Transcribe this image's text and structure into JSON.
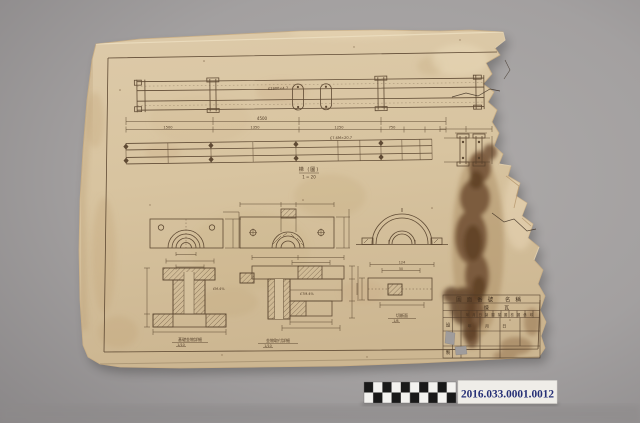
{
  "photo": {
    "accession_number": "2016.033.0001.0012"
  },
  "drawing": {
    "beam1_label": "£2800×4.7",
    "beam2_label": "£7.6M×20.7",
    "dim_total": "4500",
    "dim_seg1": "1500",
    "dim_seg2": "1350",
    "dim_seg3": "1250",
    "dim_seg4": "750",
    "scale_title": "梯 (圖)",
    "scale_ratio": "1 = 20",
    "note_f1": "£M.4%",
    "note_f2": "£7M.4%",
    "caption_g1": "基礎金物詳細",
    "caption_g1_scale": "1/10",
    "caption_g2": "金物取付詳細",
    "caption_g2_scale": "1/10",
    "caption_g3": "切斷面",
    "caption_g3_scale": "1/8",
    "dim_g3_top": "124",
    "dim_g3_mid": "50"
  },
  "title_block": {
    "row1": "圖面番號 名稱",
    "row2": "煉 瓦",
    "row3": "年月日製圖描圖檢圖係印",
    "col1": "設",
    "col2": "計",
    "col3": "製",
    "row4_cells": "年 月 日"
  }
}
